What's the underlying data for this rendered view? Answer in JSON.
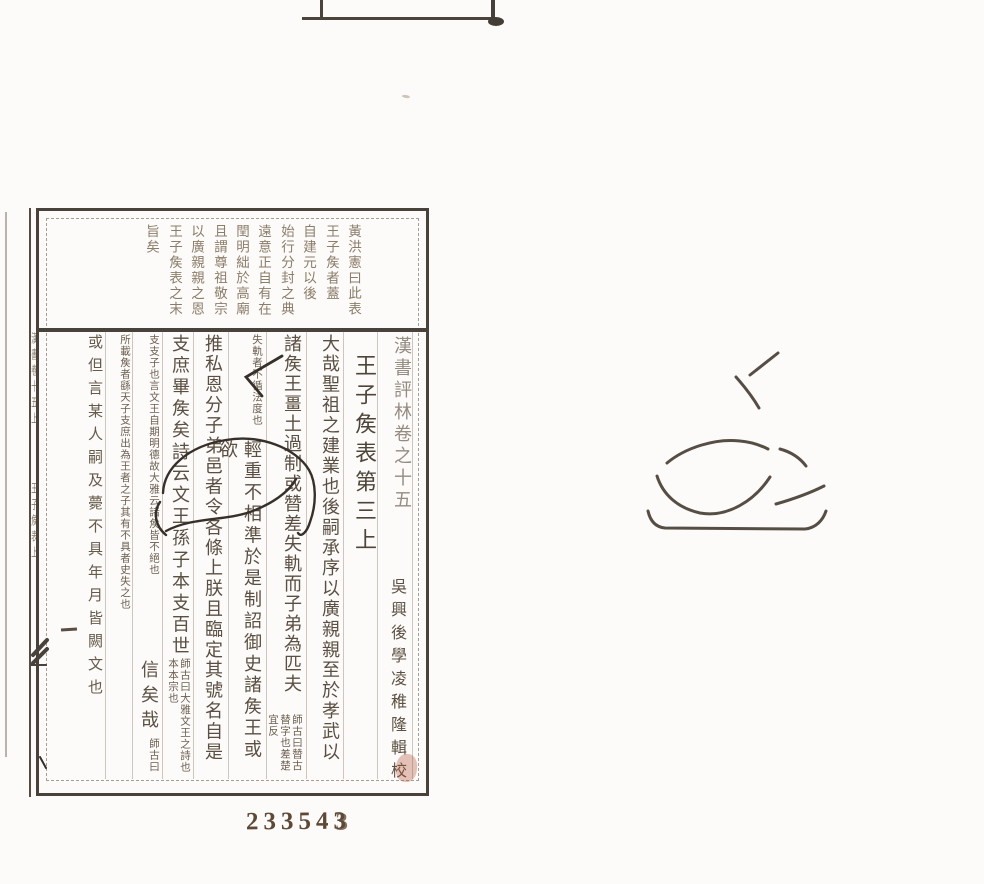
{
  "document": {
    "kind": "scanned woodblock-printed Chinese book page",
    "stamp": {
      "prefix": "23354",
      "last": "3"
    },
    "spine": {
      "upper": "漢書卷十五上",
      "lower": "王子矦表上"
    },
    "heading": {
      "book_title": "漢書評林卷之十五",
      "compiler": "吳興後學凌稚隆輯校",
      "section_title": "王子矦表第三上"
    },
    "margin_note": {
      "columns": [
        {
          "x": 352,
          "text": "黃洪憲曰此表"
        },
        {
          "x": 330,
          "text": "王子矦者蓋"
        },
        {
          "x": 307,
          "text": "自建元以後"
        },
        {
          "x": 285,
          "text": "始行分封之典"
        },
        {
          "x": 262,
          "text": "遠意正自有在"
        },
        {
          "x": 240,
          "text": "閏明絀於高廟"
        },
        {
          "x": 218,
          "text": "且謂尊祖敬宗"
        },
        {
          "x": 195,
          "text": "以廣親親之恩"
        },
        {
          "x": 173,
          "text": "王子矦表之末"
        },
        {
          "x": 150,
          "text": "旨矣"
        }
      ]
    },
    "columns": [
      {
        "x": 317,
        "w": 24,
        "parts": [
          {
            "s": "large",
            "fs": 18,
            "ls": 2.4,
            "h": 448,
            "t": "大哉聖祖之建業也後嗣承序以廣親親至於孝武以"
          }
        ]
      },
      {
        "x": 279,
        "w": 24,
        "parts": [
          {
            "s": "large",
            "fs": 18,
            "ls": 2,
            "h": 380,
            "t": "諸矦王畺土過制或㬱差失軌而子弟為匹夫"
          },
          {
            "s": "dbl",
            "h": 66,
            "t": "師古曰㬱古替字也差楚宜反"
          }
        ]
      },
      {
        "x": 239,
        "w": 24,
        "parts": [
          {
            "s": "dbl",
            "h": 106,
            "t": "失軌者不循法度也"
          },
          {
            "s": "large",
            "fs": 18,
            "ls": 3.4,
            "h": 342,
            "t": "輕重不相準於是制詔御史諸矦王或欲"
          }
        ]
      },
      {
        "x": 200,
        "w": 24,
        "parts": [
          {
            "s": "large",
            "fs": 18,
            "ls": 2.4,
            "h": 448,
            "t": "推私恩分子弟邑者令各條上朕且臨定其號名自是"
          }
        ]
      },
      {
        "x": 167,
        "w": 24,
        "parts": [
          {
            "s": "large",
            "fs": 18,
            "ls": 3.6,
            "h": 324,
            "t": "支庶畢矦矣詩云文王孫子本支百世"
          },
          {
            "s": "dbl",
            "h": 122,
            "t": "師古曰大雅文王之詩也本本宗也"
          }
        ]
      },
      {
        "x": 136,
        "w": 24,
        "parts": [
          {
            "s": "dbl",
            "h": 326,
            "t": "支支子也言文王自期明德故大雅云諸矦皆不絕也"
          },
          {
            "s": "large",
            "fs": 18,
            "ls": 7,
            "h": 78,
            "t": "信矣哉"
          },
          {
            "s": "dbl",
            "h": 42,
            "t": "師古曰"
          }
        ]
      },
      {
        "x": 107,
        "w": 24,
        "parts": [
          {
            "s": "dbl",
            "h": 446,
            "t": "所載矦者繇天子支庶出為王者之子其有不具者史失之也"
          }
        ]
      },
      {
        "x": 86,
        "w": 18,
        "parts": [
          {
            "s": "med",
            "fs": 15,
            "ls": 8,
            "h": 400,
            "t": "或但言某人嗣及薨不具年月皆闕文也"
          }
        ]
      }
    ],
    "layout": {
      "separators": [
        412,
        377,
        343,
        306,
        266,
        228,
        193,
        162,
        132,
        105
      ]
    },
    "colors": {
      "paper": "#fcfbf9",
      "border": "#49423a",
      "ink": "#5a4f42",
      "ink_faded": "#8c7d6a",
      "ink_small": "#6b5e4f",
      "handwriting": "#37302a",
      "stamp": "#5e4836",
      "red_correction": "rgba(173,72,40,0.32)"
    }
  }
}
